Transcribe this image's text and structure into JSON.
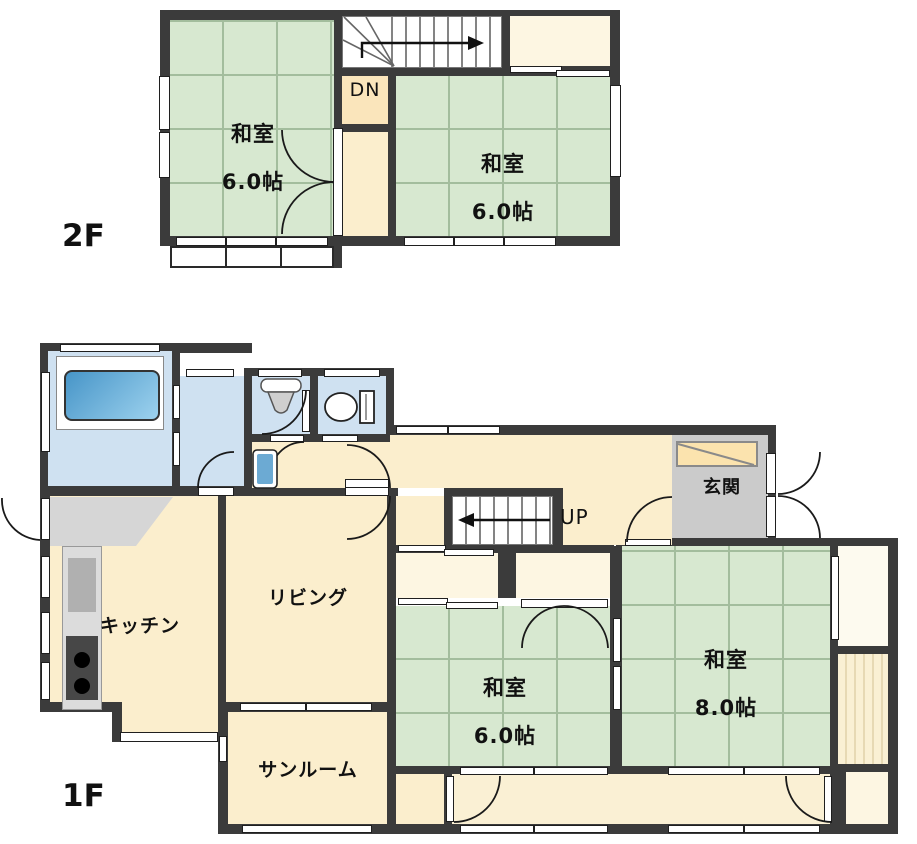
{
  "colors": {
    "wall": "#3b3b3b",
    "tatami": "#d7e8d0",
    "tatami_line": "#a3bd9d",
    "cream": "#fbeecd",
    "cream_light": "#fdf6e2",
    "dn_landing": "#fae5bb",
    "engawa": "#faf0d4",
    "engawa_stripe": "#e7d9b4",
    "water_blue": "#cfe1f1",
    "tub_light": "#9dd2ee",
    "tub_dark": "#4795c8",
    "genkan_gray": "#cbcbcb",
    "shoe_cabinet": "#fbe3ae",
    "counter": "#dcdcdc",
    "sink": "#b0b0b0",
    "stove": "#474747",
    "kitchen_floor": "#d6d6d6",
    "line": "#1a1a1a"
  },
  "floor2": {
    "label": "2F",
    "stairs": "DN",
    "rooms": {
      "washitsu_left": {
        "name": "和室",
        "size": "6.0帖"
      },
      "washitsu_right": {
        "name": "和室",
        "size": "6.0帖"
      }
    }
  },
  "floor1": {
    "label": "1F",
    "stairs": "UP",
    "rooms": {
      "kitchen": "キッチン",
      "living": "リビング",
      "sunroom": "サンルーム",
      "genkan": "玄関",
      "washitsu6": {
        "name": "和室",
        "size": "6.0帖"
      },
      "washitsu8": {
        "name": "和室",
        "size": "8.0帖"
      }
    }
  }
}
